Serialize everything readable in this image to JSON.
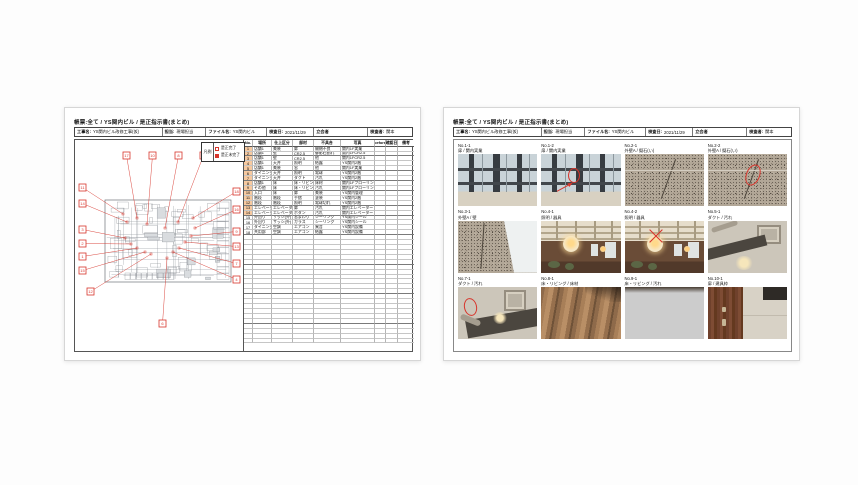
{
  "colors": {
    "annotation_red": "#d7352c",
    "highlight_orange": "#f6c9a0",
    "plan_line": "#999fa5"
  },
  "page_left": {
    "title": "帳票:全て / YS関内ビル / 是正指示書(まとめ)",
    "header": {
      "project_label": "工事名:",
      "project": "YS関内ビル改修工事(仮)",
      "manager_label": "担当:",
      "manager": "現場担当",
      "file_label": "ファイル名:",
      "file": "YS関内ビル",
      "date_label": "検査日:",
      "date": "2021/11/29",
      "witness_label": "立会者",
      "witness": "",
      "inspector_label": "検査者:",
      "inspector": "関本"
    },
    "legend": {
      "label": "凡例",
      "items": [
        {
          "swatch": "outline",
          "text": "是正完了"
        },
        {
          "swatch": "filled",
          "text": "是正未完了"
        }
      ]
    },
    "plan": {
      "callouts": [
        {
          "n": "17",
          "bx": 48,
          "by": 12,
          "tx": 62,
          "ty": 78
        },
        {
          "n": "10",
          "bx": 74,
          "by": 12,
          "tx": 72,
          "ty": 84
        },
        {
          "n": "8",
          "bx": 100,
          "by": 12,
          "tx": 90,
          "ty": 88
        },
        {
          "n": "5",
          "bx": 125,
          "by": 12,
          "tx": 103,
          "ty": 82
        },
        {
          "n": "11",
          "bx": 4,
          "by": 44,
          "tx": 48,
          "ty": 74
        },
        {
          "n": "14",
          "bx": 4,
          "by": 60,
          "tx": 52,
          "ty": 82
        },
        {
          "n": "3",
          "bx": 4,
          "by": 86,
          "tx": 50,
          "ty": 98
        },
        {
          "n": "2",
          "bx": 4,
          "by": 100,
          "tx": 56,
          "ty": 104
        },
        {
          "n": "1",
          "bx": 4,
          "by": 113,
          "tx": 62,
          "ty": 108
        },
        {
          "n": "15",
          "bx": 4,
          "by": 127,
          "tx": 70,
          "ty": 112
        },
        {
          "n": "12",
          "bx": 12,
          "by": 148,
          "tx": 76,
          "ty": 114
        },
        {
          "n": "18",
          "bx": 158,
          "by": 48,
          "tx": 118,
          "ty": 78
        },
        {
          "n": "16",
          "bx": 158,
          "by": 66,
          "tx": 120,
          "ty": 88
        },
        {
          "n": "9",
          "bx": 158,
          "by": 88,
          "tx": 116,
          "ty": 96
        },
        {
          "n": "13",
          "bx": 158,
          "by": 103,
          "tx": 110,
          "ty": 102
        },
        {
          "n": "7",
          "bx": 158,
          "by": 120,
          "tx": 104,
          "ty": 108
        },
        {
          "n": "4",
          "bx": 158,
          "by": 136,
          "tx": 98,
          "ty": 112
        },
        {
          "n": "6",
          "bx": 84,
          "by": 180,
          "tx": 92,
          "ty": 118
        }
      ]
    },
    "table": {
      "columns": [
        "No.",
        "場所",
        "仕上区分",
        "部材",
        "不具合",
        "写真",
        "before",
        "確認日",
        "備考"
      ],
      "rows": [
        {
          "no": "1",
          "hl": true,
          "cells": [
            "店舗1",
            "美装",
            "扉",
            "開閉不良",
            "関内1F実業"
          ]
        },
        {
          "no": "2",
          "hl": true,
          "cells": [
            "店舗1",
            "壁",
            "CR2.5",
            "御影石割れ",
            "関内1FCR2.5"
          ]
        },
        {
          "no": "3",
          "hl": true,
          "cells": [
            "店舗1",
            "壁",
            "CR2.5",
            "他",
            "関内1FCR2.5"
          ]
        },
        {
          "no": "4",
          "hl": true,
          "cells": [
            "店舗1",
            "天井",
            "照明",
            "結露",
            "YS関内2階"
          ]
        },
        {
          "no": "5",
          "hl": true,
          "cells": [
            "店舗1",
            "美装",
            "窓",
            "他",
            "関内1F実業"
          ]
        },
        {
          "no": "6",
          "hl": true,
          "cells": [
            "ダイニング",
            "天井",
            "照明",
            "電球",
            "YS関内2階"
          ]
        },
        {
          "no": "7",
          "hl": true,
          "cells": [
            "ダイニング",
            "天井",
            "ダクト",
            "汚れ",
            "YS関内2階"
          ]
        },
        {
          "no": "8",
          "hl": true,
          "cells": [
            "店舗1",
            "床",
            "床・リビング",
            "床材",
            "関内1Fフローリング"
          ]
        },
        {
          "no": "9",
          "hl": true,
          "cells": [
            "その他",
            "床",
            "床・リビング",
            "汚れ",
            "関内1Fフローリング"
          ]
        },
        {
          "no": "10",
          "hl": true,
          "cells": [
            "入口",
            "床",
            "扉",
            "美装",
            "YS関内管理"
          ]
        },
        {
          "no": "11",
          "hl": true,
          "cells": [
            "階段",
            "階段",
            "手摺",
            "塗装",
            "YS関内2階"
          ]
        },
        {
          "no": "12",
          "hl": true,
          "cells": [
            "階段",
            "階段",
            "照明",
            "電球切れ",
            "YS関内2階"
          ]
        },
        {
          "no": "13",
          "hl": true,
          "cells": [
            "エレベーター",
            "エレベーター",
            "扉",
            "汚れ",
            "関内エレベーター"
          ]
        },
        {
          "no": "14",
          "hl": true,
          "cells": [
            "エレベーター",
            "エレベーター",
            "ボタン",
            "汚れ",
            "関内エレベーター"
          ]
        },
        {
          "no": "15",
          "hl": false,
          "cells": [
            "外回り",
            "サッシ(外)",
            "窓まわり",
            "シーリング",
            "YS関内シール"
          ]
        },
        {
          "no": "16",
          "hl": false,
          "cells": [
            "外回り",
            "サッシ(外)",
            "ガラス",
            "シーリング",
            "YS関内シール"
          ]
        },
        {
          "no": "17",
          "hl": false,
          "cells": [
            "ダイニング",
            "空調",
            "エアコン",
            "異音",
            "YS関内設備"
          ]
        },
        {
          "no": "18",
          "hl": false,
          "cells": [
            "共用部",
            "空調",
            "エアコン",
            "結露",
            "YS関内設備"
          ]
        }
      ],
      "empty_rows": 22,
      "group_breaks": [
        2,
        5,
        7,
        9,
        12,
        14,
        18,
        24,
        30,
        36
      ]
    }
  },
  "page_right": {
    "title": "帳票:全て / YS関内ビル / 是正指示書(まとめ)",
    "header": {
      "project_label": "工事名:",
      "project": "YS関内ビル改修工事(仮)",
      "manager_label": "担当:",
      "manager": "現場担当",
      "file_label": "ファイル名:",
      "file": "YS関内ビル",
      "date_label": "検査日:",
      "date": "2021/11/29",
      "witness_label": "立会者",
      "witness": "",
      "inspector_label": "検査者:",
      "inspector": "関本"
    },
    "photos": [
      {
        "no": "No.1-1",
        "caption": "扉 / 関内実業",
        "type": "door-glass",
        "annotation": ""
      },
      {
        "no": "No.1-2",
        "caption": "扉 / 関内実業",
        "type": "door-glass",
        "annotation": "circle-arrow"
      },
      {
        "no": "No.2-1",
        "caption": "外壁A / 擬石(い)",
        "type": "granite",
        "annotation": ""
      },
      {
        "no": "No.2-2",
        "caption": "外壁A / 擬石(い)",
        "type": "granite",
        "annotation": "ellipse"
      },
      {
        "no": "No.3-1",
        "caption": "外壁A / 壁",
        "type": "granite-corner",
        "annotation": ""
      },
      {
        "no": "No.4-1",
        "caption": "照明 / 器具",
        "type": "restaurant",
        "annotation": ""
      },
      {
        "no": "No.4-2",
        "caption": "照明 / 器具",
        "type": "restaurant",
        "annotation": "x"
      },
      {
        "no": "No.5-1",
        "caption": "ダクト / 汚れ",
        "type": "duct",
        "annotation": ""
      },
      {
        "no": "No.7-1",
        "caption": "ダクト / 汚れ",
        "type": "duct2",
        "annotation": "circle-left"
      },
      {
        "no": "No.8-1",
        "caption": "床・リビング / 床材",
        "type": "wood",
        "annotation": ""
      },
      {
        "no": "No.9-1",
        "caption": "床・リビング / 汚れ",
        "type": "wood-light",
        "annotation": ""
      },
      {
        "no": "No.10-1",
        "caption": "扉 / 建具枠",
        "type": "door-wood",
        "annotation": ""
      }
    ]
  }
}
